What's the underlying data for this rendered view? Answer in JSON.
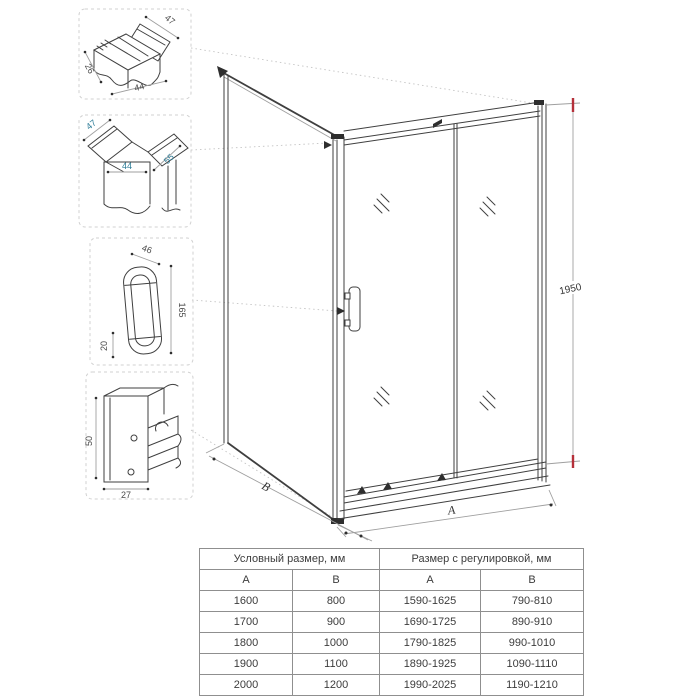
{
  "detail_boxes": {
    "top_profile": {
      "dim_flange": "47",
      "dim_side": "26",
      "dim_width": "44"
    },
    "corner_profile": {
      "dim_left": "47",
      "dim_width": "44",
      "dim_right": "55"
    },
    "handle": {
      "dim_top": "46",
      "dim_height": "165",
      "dim_bottom": "20"
    },
    "wall_profile": {
      "dim_height": "50",
      "dim_width": "27"
    }
  },
  "dimensions": {
    "height": "1950",
    "width_label": "A",
    "depth_label": "B"
  },
  "table": {
    "header_nominal": "Условный размер, мм",
    "header_adjusted": "Размер с регулировкой, мм",
    "col_a": "A",
    "col_b": "B",
    "rows": [
      {
        "a": "1600",
        "b": "800",
        "a_adj": "1590-1625",
        "b_adj": "790-810"
      },
      {
        "a": "1700",
        "b": "900",
        "a_adj": "1690-1725",
        "b_adj": "890-910"
      },
      {
        "a": "1800",
        "b": "1000",
        "a_adj": "1790-1825",
        "b_adj": "990-1010"
      },
      {
        "a": "1900",
        "b": "1100",
        "a_adj": "1890-1925",
        "b_adj": "1090-1110"
      },
      {
        "a": "2000",
        "b": "1200",
        "a_adj": "1990-2025",
        "b_adj": "1190-1210"
      }
    ]
  },
  "colors": {
    "line": "#3f3f3f",
    "dim_accent": "#2e7d98",
    "dim_marker": "#b5303a",
    "table_border": "#8f8f8f"
  }
}
